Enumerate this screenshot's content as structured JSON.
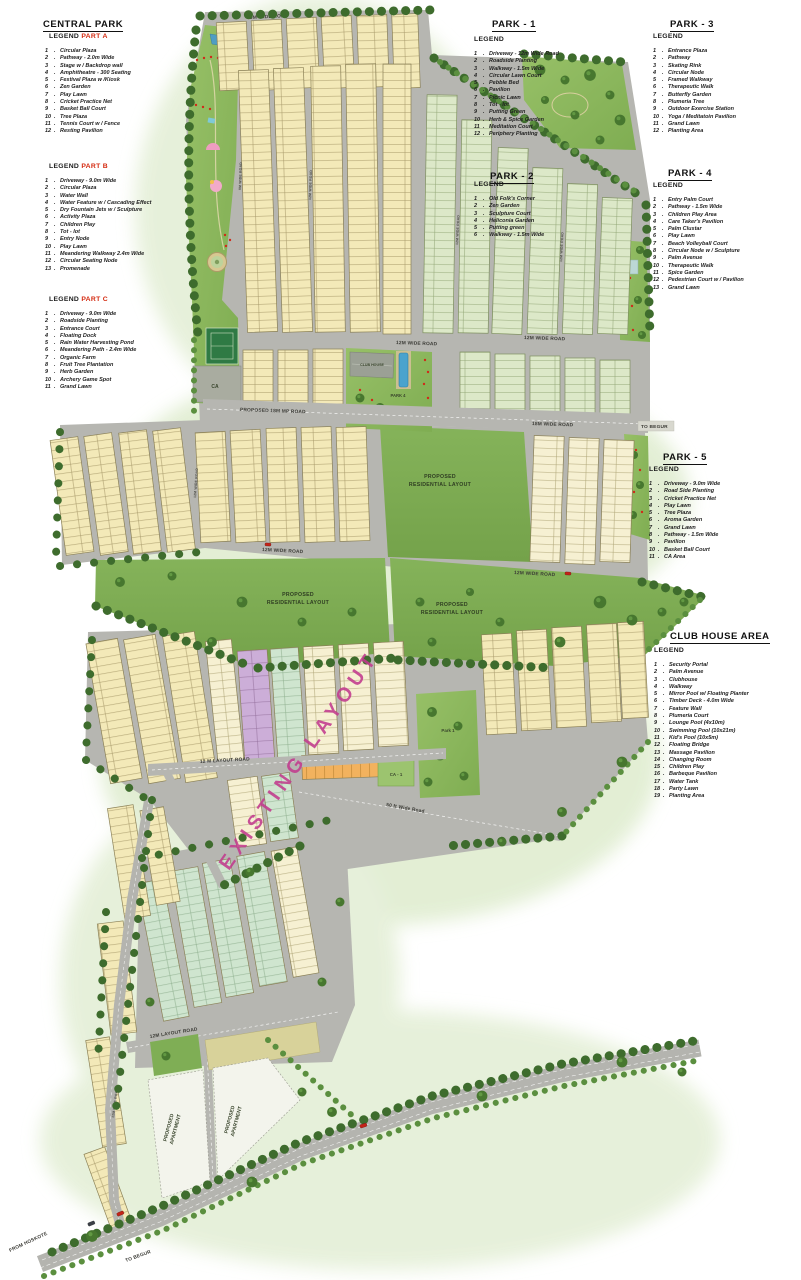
{
  "legends": {
    "central_park": {
      "title": "CENTRAL PARK",
      "sections": [
        {
          "label": "LEGEND",
          "part": "PART A",
          "items": [
            "Circular Plaza",
            "Pathway - 2.0m Wide",
            "Stage w / Backdrop wall",
            "Amphitheatre - 300 Seating",
            "Festival Plaza w /Kiosk",
            "Zen Garden",
            "Play Lawn",
            "Cricket Practice Net",
            "Basket Ball Court",
            "Tree Plaza",
            "Tennis Court w / Fence",
            "Resting Pavilion"
          ]
        },
        {
          "label": "LEGEND",
          "part": "PART B",
          "items": [
            "Driveway - 9.0m Wide",
            "Circular Plaza",
            "Water Wall",
            "Water Feature w / Cascading Effect",
            "Dry Fountain Jets w / Sculpture",
            "Activity Plaza",
            "Children Play",
            "Tot - lot",
            "Entry Node",
            "Play Lawn",
            "Meandering Walkway 2.4m Wide",
            "Circular Seating Node",
            "Promenade"
          ]
        },
        {
          "label": "LEGEND",
          "part": "PART C",
          "items": [
            "Driveway - 9.0m Wide",
            "Roadside Planting",
            "Entrance Court",
            "Floating Dock",
            "Rain Water Harvesting Pond",
            "Meandering Path - 2.4m Wide",
            "Organic Farm",
            "Fruit Tree Plantation",
            "Herb Garden",
            "Archery Game Spot",
            "Grand Lawn"
          ]
        }
      ]
    },
    "park_1": {
      "title": "PARK - 1",
      "label": "LEGEND",
      "items": [
        "Driveway - 12m Wide Road",
        "Roadside Planting",
        "Walkway - 1.5m Wide",
        "Circular Lawn Court",
        "Pebble Bed",
        "Pavilion",
        "Picnic Lawn",
        "Tot - lot",
        "Putting Green",
        "Herb & Spice Garden",
        "Meditation Court",
        "Periphery Planting"
      ]
    },
    "park_2": {
      "title": "PARK - 2",
      "label": "LEGEND",
      "items": [
        "Old Folk's Corner",
        "Zen Garden",
        "Sculpture Court",
        "Heliconia Garden",
        "Putting green",
        "Walkway - 1.5m Wide"
      ]
    },
    "park_3": {
      "title": "PARK - 3",
      "label": "LEGEND",
      "items": [
        "Entrance Plaza",
        "Pathway",
        "Skating Rink",
        "Circular Node",
        "Framed Walkway",
        "Therapeutic Walk",
        "Butterfly Garden",
        "Plumeria Tree",
        "Outdoor Exercise Station",
        "Yoga / Meditatoin Pavilion",
        "Grand Lawn",
        "Planting Area"
      ]
    },
    "park_4": {
      "title": "PARK - 4",
      "label": "LEGEND",
      "items": [
        "Entry Palm Court",
        "Pathway - 1.5m Wide",
        "Children Play Area",
        "Care Taker's Pavilion",
        "Palm Clustar",
        "Play Lawn",
        "Beach Volleyball Court",
        "Circular Node w / Sculpture",
        "Palm Avenue",
        "Therapeutic Walk",
        "Spice Garden",
        "Pedestrian Court w / Pavilion",
        "Grand Lawn"
      ]
    },
    "park_5": {
      "title": "PARK - 5",
      "label": "LEGEND",
      "items": [
        "Driveway - 9.0m Wide",
        "Road Side Planting",
        "Cricket Practice Net",
        "Play Lawn",
        "Tree Plaza",
        "Aroma Garden",
        "Grand Lawn",
        "Pathway - 1.5m Wide",
        "Pavilion",
        "Basket Ball Court",
        "CA Area"
      ]
    },
    "club_house_area": {
      "title": "CLUB HOUSE AREA",
      "label": "LEGEND",
      "items": [
        "Security Portal",
        "Palm Avenue",
        "Clubhouse",
        "Walkway",
        "Mirror Pool w/ Floating Planter",
        "Timber Deck - 4.0m Wide",
        "Feature Wall",
        "Plumeria Court",
        "Lounge Pool (4x10m)",
        "Swimming Pool (10x21m)",
        "Kid's Pool (10x5m)",
        "Floating Bridge",
        "Massage Pavilion",
        "Changing Room",
        "Children Play",
        "Barbeque Pavilion",
        "Water Tank",
        "Party Lawn",
        "Planting Area"
      ]
    }
  },
  "map": {
    "road_labels": {
      "top_road": "9M WIDE ROAD",
      "mp_road": "PROPOSED 18M MP ROAD",
      "wide_18m": "18M WIDE ROAD",
      "wide_12m": "12M WIDE ROAD",
      "wide_9m": "9M WIDE ROAD",
      "layout_12m": "12 M LAYOUT ROAD",
      "layout_12m_b": "12M LAYOUT ROAD",
      "wide_50ft": "50 ft Wide Road",
      "to_begur": "TO BEGUR",
      "from_hoskote": "FROM HOSKOTE"
    },
    "area_labels": {
      "prl_1": "PROPOSED",
      "prl_2": "RESIDENTIAL LAYOUT",
      "apartment_1": "PROPOSED",
      "apartment_2": "APARTMENT",
      "existing_layout": "EXISTING LAYOUT",
      "club_house": "CLUB HOUSE",
      "park_4": "PARK 4",
      "park_1": "Park 1",
      "ca": "CA",
      "ca_1": "CA - 1"
    },
    "colors": {
      "plot_yellow": "#f3e9b8",
      "plot_green": "#dce8c8",
      "plot_mint": "#cfe5cf",
      "plot_orange": "#f2b25e",
      "plot_purple": "#ccaed8",
      "road_gray": "#b6b6b1",
      "park_green": "#8cb85e",
      "residential_green": "#7fae55",
      "existing_magenta": "#c23b8e",
      "pool_blue": "#4aa3cd",
      "flower_red": "#d02a1a"
    }
  }
}
